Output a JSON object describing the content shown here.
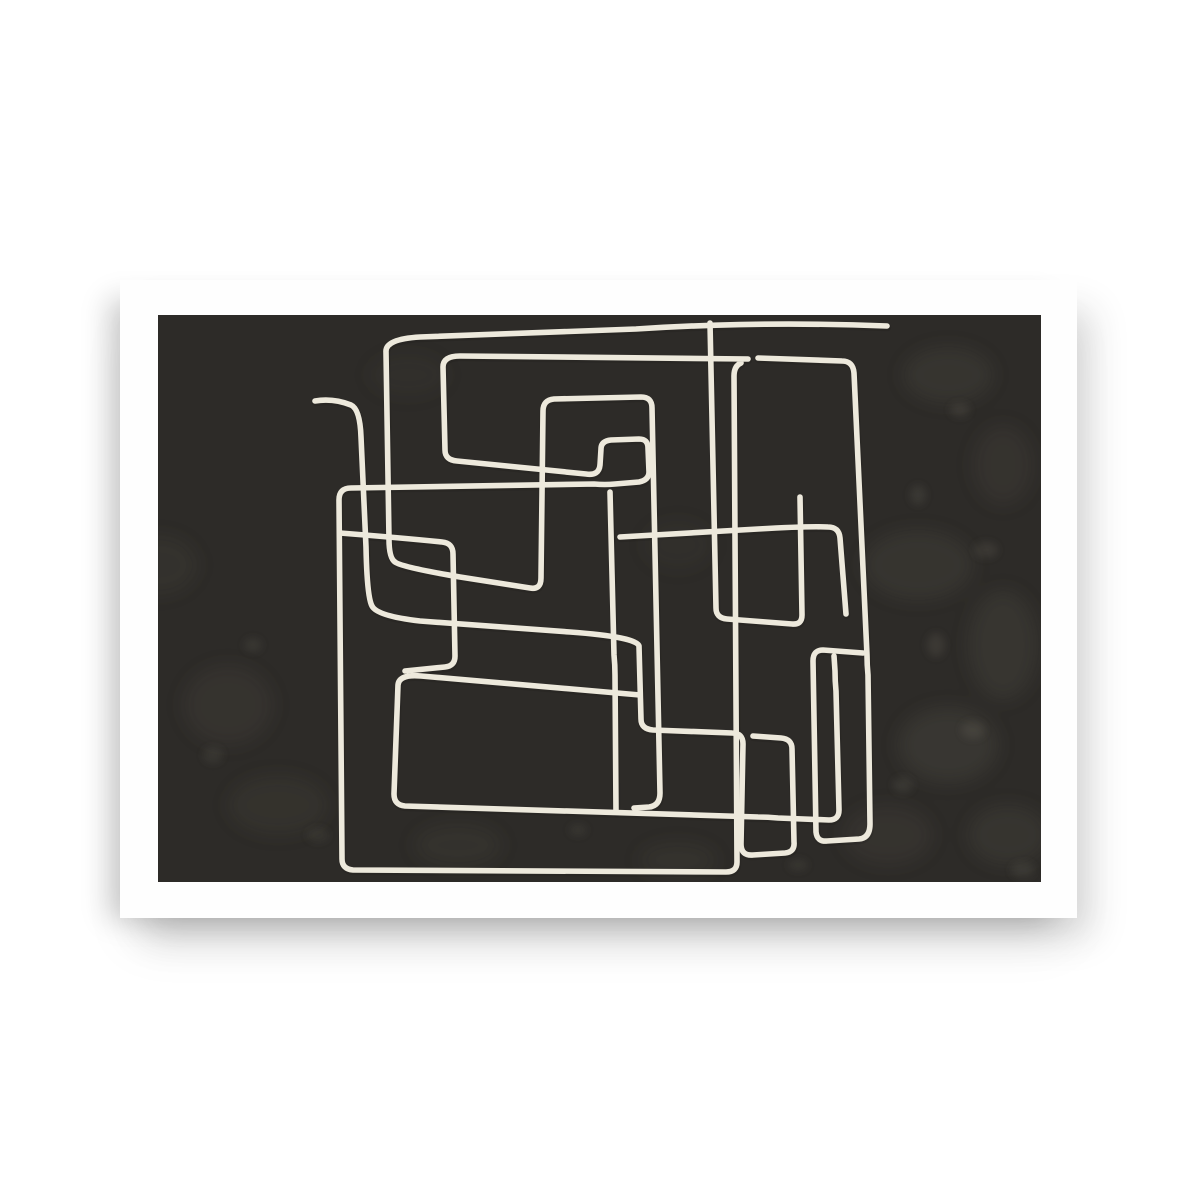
{
  "page": {
    "background_color": "#ffffff",
    "description": "Product mockup photo of an abstract art poster on a white background"
  },
  "poster": {
    "mat_color": "#fefefe",
    "art_background_color": "#2D2B28",
    "line_color": "#EDE9DC",
    "texture_color": "#8d8878",
    "description": "Abstract one-line maze drawing: a continuous cream line forming overlapping rectangular loops and spirals on a dark charcoal textured field, framed by a wide white mat"
  },
  "artwork": {
    "viewbox": "0 0 883 567",
    "strokes": [
      {
        "name": "tail-and-small-rect-spiral",
        "d": "M157,86 Q175,83 193,90 Q202,94 203,122 L208,232 Q209,282 214,291 Q219,301 262,306 L412,317 Q479,322 481,331 L483,404 Q483,414 495,415 L574,418 Q585,418 585,429 L583,529 Q583,541 595,540 L627,538 Q637,537 636,527 L634,434 Q634,424 623,423 L595,421"
      },
      {
        "name": "big-left-loop-with-hook",
        "d": "M590,44 L302,41 Q285,41 285,52 L287,135 Q287,145 299,146 L428,159 Q441,161 442,150 L443,134 Q443,126 453,125 L481,124 Q490,124 490,133 L491,157 Q491,165 481,167 L457,169 Q447,170 436,169 L193,173 Q181,173 181,185 L184,544 Q184,554 195,555 L568,557 Q579,557 579,547 L576,61 Q576,51 583,48"
      },
      {
        "name": "outer-top-spiral",
        "d": "M729,11 Q600,6 478,14 L262,22 Q227,24 228,37 L231,224 Q231,243 237,247 Q243,252 302,262 L372,273 Q383,275 383,263 L385,96 Q385,85 396,84 L483,82 Q494,82 494,93 L502,478 Q502,491 491,492 L476,493"
      },
      {
        "name": "center-right-vertical-arm",
        "d": "M552,8 C554,100 556,200 558,293 Q558,303 569,304 L634,309 Q644,310 644,300 L642,182"
      },
      {
        "name": "mid-left-step",
        "d": "M182,218 Q245,223 284,227 Q295,228 295,239 L297,341 Q297,351 287,352 L247,356"
      },
      {
        "name": "inner-middle-rect",
        "d": "M482,380 L263,361 Q241,359 240,370 L236,479 Q236,490 247,491 L600,502 Q610,502 620,503 L671,505 Q681,505 681,495 L678,376 Q677,366 677,356 L676,341"
      },
      {
        "name": "hook-descender",
        "d": "M452,177 L456,340 Q457,350 457,360 L458,497"
      },
      {
        "name": "right-mid-shelf",
        "d": "M462,222 L600,214 Q651,211 670,212 Q681,212 682,223 L688,299"
      },
      {
        "name": "right-tall-loop-and-narrow-rect",
        "d": "M600,43 L684,46 Q695,46 696,58 L709,340 Q709,350 710,360 L712,509 Q712,523 701,524 L669,526 Q659,527 658,517 L655,346 Q655,335 665,335 L705,338"
      }
    ]
  }
}
